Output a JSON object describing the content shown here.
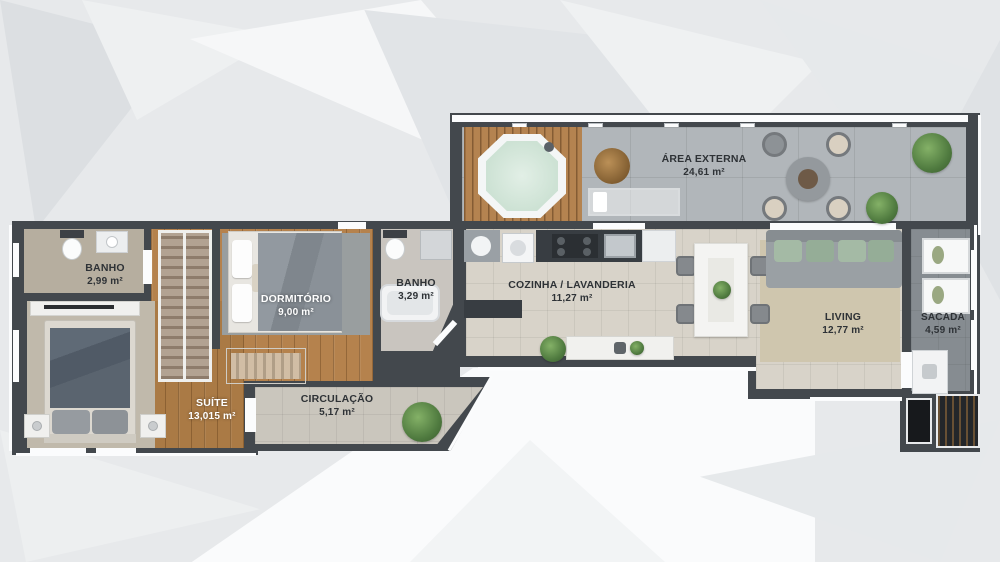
{
  "rooms": {
    "banho1": {
      "name": "BANHO",
      "area": "2,99 m²"
    },
    "dormitorio": {
      "name": "DORMITÓRIO",
      "area": "9,00 m²"
    },
    "banho2": {
      "name": "BANHO",
      "area": "3,29 m²"
    },
    "cozinha": {
      "name": "COZINHA / LAVANDERIA",
      "area": "11,27 m²"
    },
    "area_externa": {
      "name": "ÁREA EXTERNA",
      "area": "24,61 m²"
    },
    "living": {
      "name": "LIVING",
      "area": "12,77 m²"
    },
    "sacada": {
      "name": "SACADA",
      "area": "4,59 m²"
    },
    "suite": {
      "name": "SUÍTE",
      "area": "13,015 m²"
    },
    "circulacao": {
      "name": "CIRCULAÇÃO",
      "area": "5,17 m²"
    }
  },
  "palette": {
    "wall": "#43484d",
    "wood_floor": "#b5824d",
    "deck_wood": "#b48350",
    "tile_kitchen": "#d8d3c9",
    "tile_externa": "#b1b6ba",
    "tile_sacada": "#868c91",
    "plant_green": "#5d8f4e",
    "label_dark": "#2e3236",
    "label_light": "#ffffff"
  }
}
